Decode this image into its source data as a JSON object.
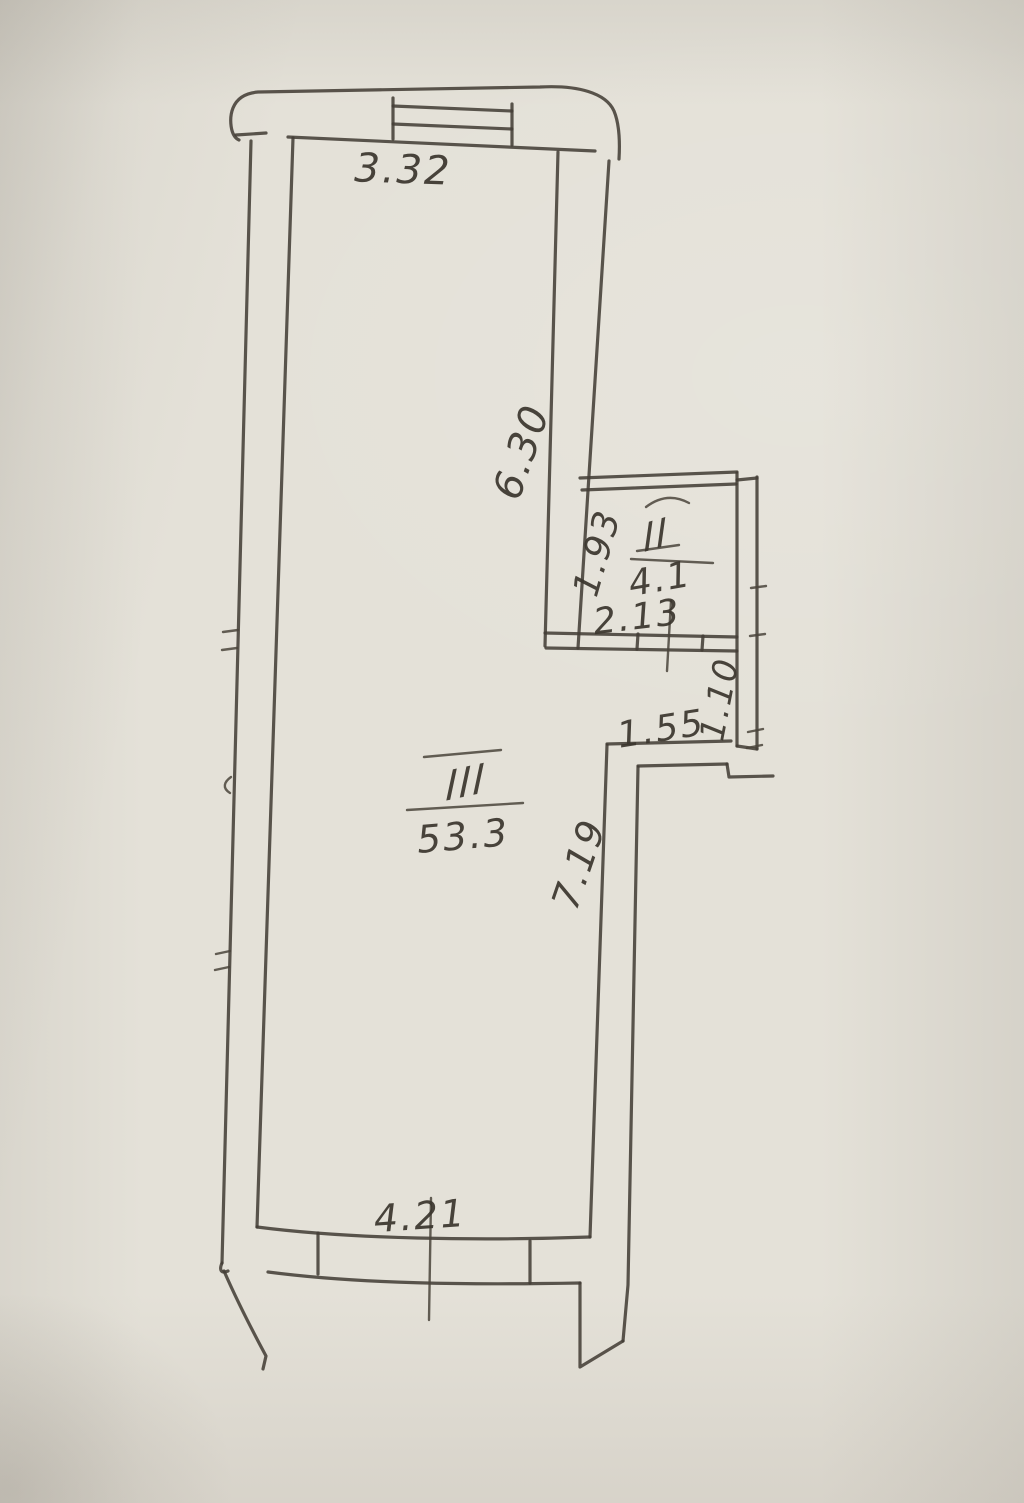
{
  "plan": {
    "labels": {
      "top_width": "3.32",
      "upper_right_wall": "6.30",
      "room2_height": "1.93",
      "room2_number": "II",
      "room2_area": "4.1",
      "room2_width": "2.13",
      "nook_width": "1.55",
      "nook_height": "1.10",
      "room3_number": "III",
      "room3_area": "53.3",
      "lower_right_wall": "7.19",
      "bottom_width": "4.21"
    },
    "colors": {
      "paper": "#e4e1d8",
      "ink": "#443f37"
    }
  }
}
